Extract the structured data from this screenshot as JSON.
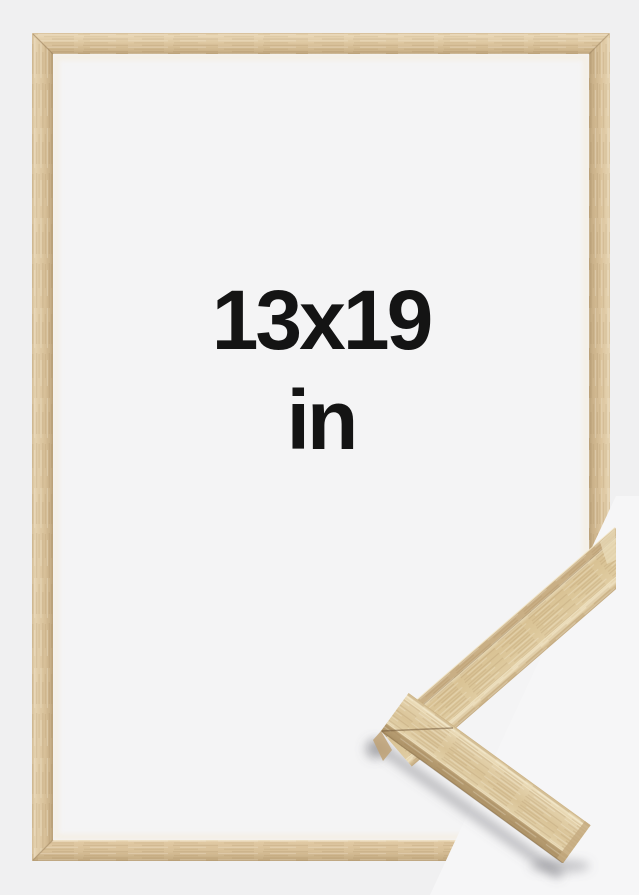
{
  "canvas": {
    "width": 639,
    "height": 895,
    "background_color": "#f0f0f1"
  },
  "frame_preview": {
    "size_label": {
      "line1": "13x19",
      "line2": "in"
    },
    "label_color": "#141414",
    "interior_color": "#f4f4f5",
    "corner_detail_background": "#f6f6f7",
    "wood_colors": {
      "base": "#dcc59e",
      "highlight": "#eee0bf",
      "shadow": "#c2a87e"
    }
  }
}
